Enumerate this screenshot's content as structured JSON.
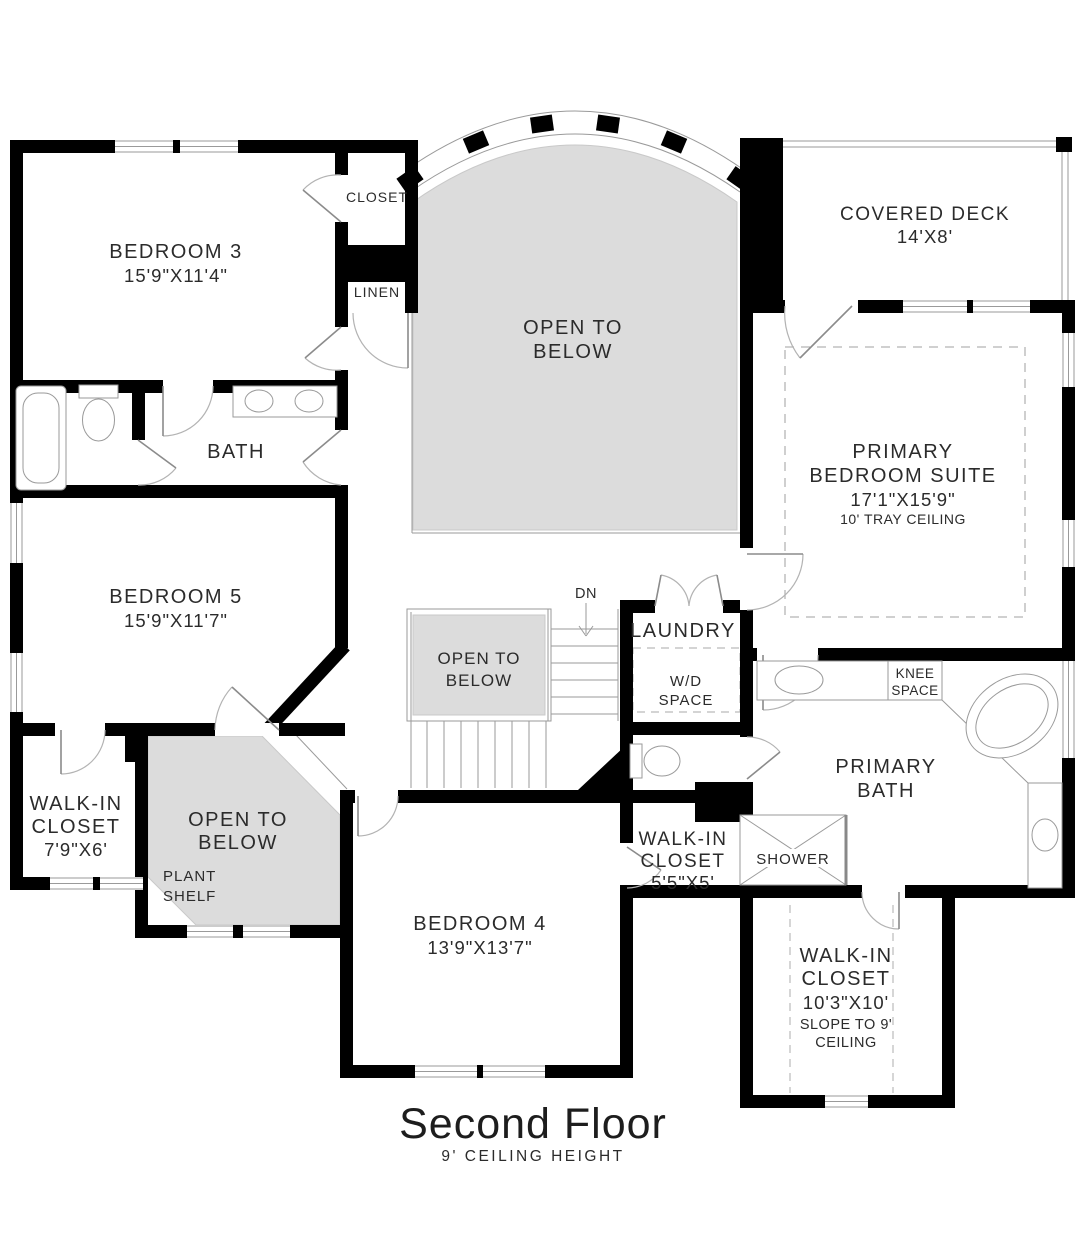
{
  "title": {
    "main": "Second Floor",
    "sub": "9' CEILING HEIGHT"
  },
  "colors": {
    "wall": "#000000",
    "open_area_fill": "#dcdcdc",
    "thin_line": "#9a9a9a",
    "text": "#2b2b2b"
  },
  "rooms": {
    "bedroom3": {
      "lines": [
        "BEDROOM 3",
        "15'9\"X11'4\""
      ]
    },
    "closet": {
      "lines": [
        "CLOSET"
      ]
    },
    "linen": {
      "lines": [
        "LINEN"
      ]
    },
    "bath": {
      "lines": [
        "BATH"
      ]
    },
    "bedroom5": {
      "lines": [
        "BEDROOM 5",
        "15'9\"X11'7\""
      ]
    },
    "walkin_closet_small": {
      "lines": [
        "WALK-IN",
        "CLOSET",
        "7'9\"X6'"
      ]
    },
    "open_below_main": {
      "lines": [
        "OPEN TO",
        "BELOW"
      ]
    },
    "open_below_stairs": {
      "lines": [
        "OPEN TO",
        "BELOW"
      ]
    },
    "open_below_plant": {
      "lines": [
        "OPEN TO",
        "BELOW"
      ]
    },
    "plant_shelf": {
      "lines": [
        "PLANT",
        "SHELF"
      ]
    },
    "stairs": {
      "down_label": "DN"
    },
    "laundry": {
      "lines": [
        "LAUNDRY"
      ],
      "wd": [
        "W/D",
        "SPACE"
      ]
    },
    "covered_deck": {
      "lines": [
        "COVERED DECK",
        "14'X8'"
      ]
    },
    "primary_suite": {
      "lines": [
        "PRIMARY",
        "BEDROOM SUITE",
        "17'1\"X15'9\"",
        "10' TRAY CEILING"
      ]
    },
    "knee_space": {
      "lines": [
        "KNEE",
        "SPACE"
      ]
    },
    "primary_bath": {
      "lines": [
        "PRIMARY",
        "BATH"
      ]
    },
    "shower": {
      "lines": [
        "SHOWER"
      ]
    },
    "walkin_closet_bed4": {
      "lines": [
        "WALK-IN",
        "CLOSET",
        "5'5\"X5'"
      ]
    },
    "bedroom4": {
      "lines": [
        "BEDROOM 4",
        "13'9\"X13'7\""
      ]
    },
    "walkin_closet_primary": {
      "lines": [
        "WALK-IN",
        "CLOSET",
        "10'3\"X10'",
        "SLOPE TO 9'",
        "CEILING"
      ]
    }
  }
}
